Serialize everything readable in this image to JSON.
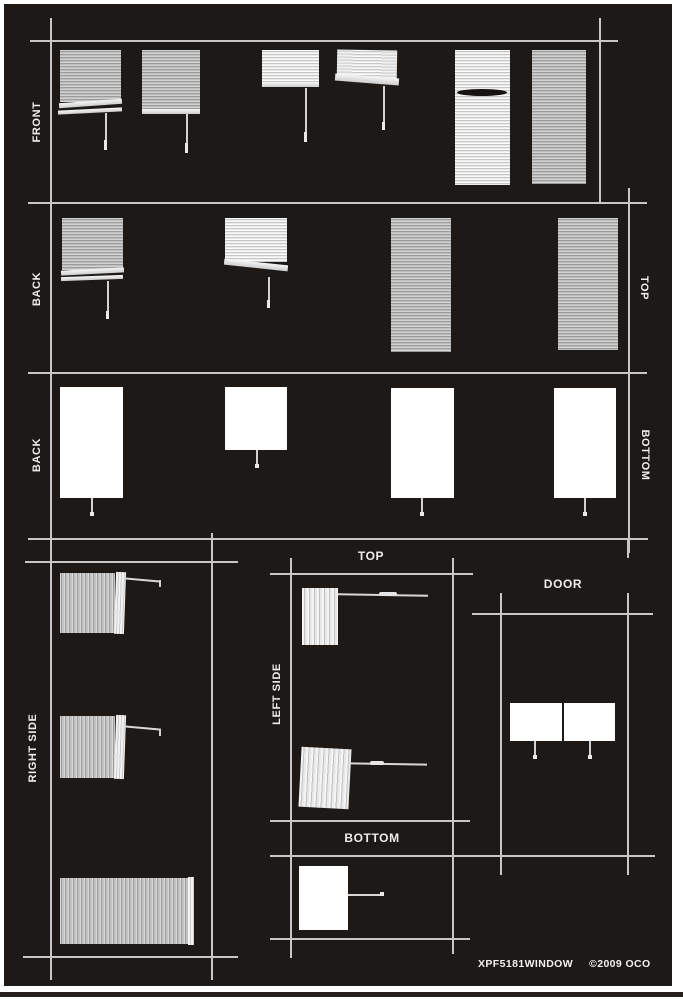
{
  "sheet_type": "window blinds pattern sheet",
  "panel_labels": {
    "front": "FRONT",
    "back_row2": "BACK",
    "back_row3": "BACK",
    "top_right": "TOP",
    "bottom_right": "BOTTOM",
    "right_side": "RIGHT SIDE",
    "left_side": "LEFT SIDE",
    "top_middle": "TOP",
    "bottom_middle": "BOTTOM",
    "door": "DOOR"
  },
  "footer": {
    "part_number": "XPF5181WINDOW",
    "copyright": "©2009 OCO"
  },
  "colors": {
    "page": "#ffffff",
    "sheet_background": "#1d1916",
    "grid_line": "#c9c7c4",
    "blind_gray": "#bdbdbd",
    "blind_bright": "#ebebeb",
    "solid_panel": "#ffffff",
    "label_text": "#ededed"
  },
  "sections": [
    {
      "label": "FRONT",
      "graphics": "6 venetian blinds, raised to fully lowered"
    },
    {
      "label": "BACK / TOP",
      "graphics": "2 partly raised blinds, 2 fully lowered blinds"
    },
    {
      "label": "BACK / BOTTOM",
      "graphics": "4 solid white shade panels with pull cords"
    },
    {
      "label": "RIGHT SIDE",
      "graphics": "3 sideways blinds with tilt wands"
    },
    {
      "label": "LEFT SIDE / TOP / BOTTOM",
      "graphics": "2 sideways blinds and 1 white panel"
    },
    {
      "label": "DOOR",
      "graphics": "2 white panels with pull cords"
    }
  ]
}
